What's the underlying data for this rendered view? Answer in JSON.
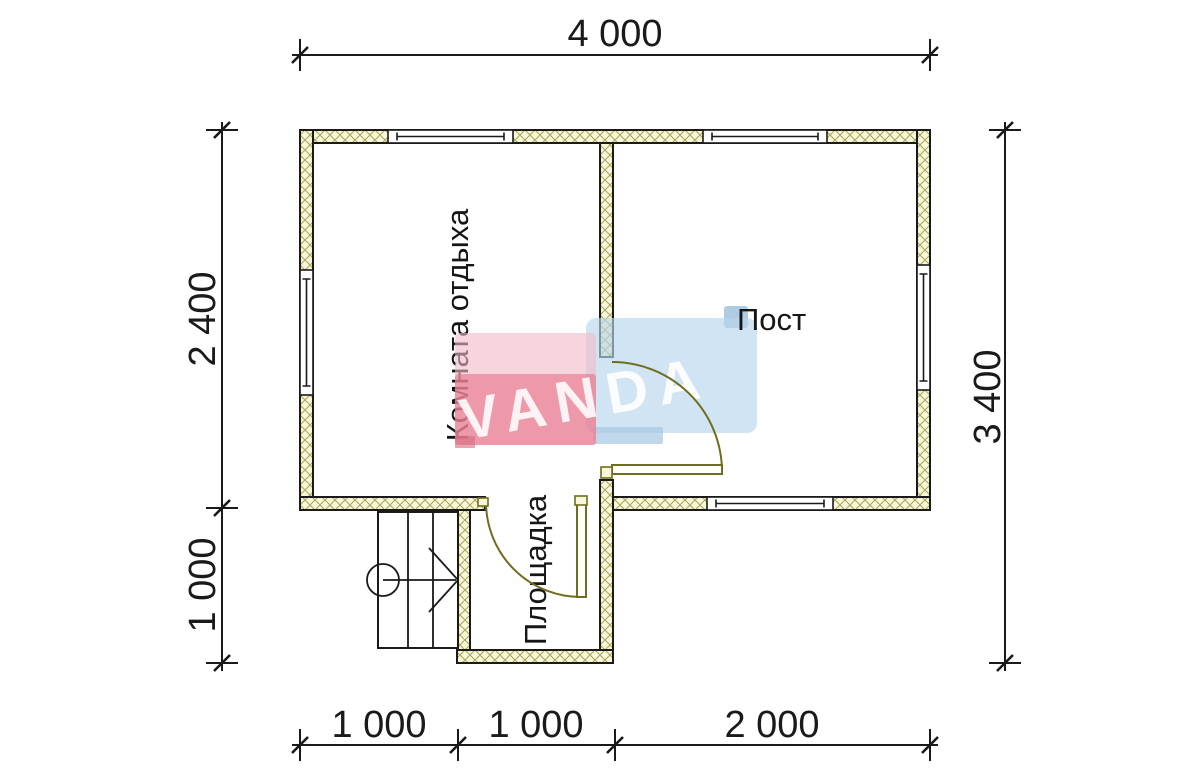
{
  "logo": {
    "text": "VANDA"
  },
  "rooms": [
    {
      "id": "rest-room",
      "label": "Комната отдыха"
    },
    {
      "id": "post-room",
      "label": "Пост"
    },
    {
      "id": "landing",
      "label": "Площадка"
    }
  ],
  "dimensions": {
    "top": "4 000",
    "left_upper": "2 400",
    "left_lower": "1 000",
    "right": "3 400",
    "bottom": [
      "1 000",
      "1 000",
      "2 000"
    ]
  },
  "colors": {
    "wall_fill": "#f8f7d8",
    "wall_hatch": "#a9a55c",
    "line": "#1a1a1a",
    "door": "#6e6e1e",
    "logo_pink": "#f2b9c8",
    "logo_red": "#e56780",
    "logo_red_dark": "#d96a7e",
    "logo_blue": "#b9d6ec",
    "logo_blue_dark": "#8fb6d7",
    "logo_step_blue": "#a5c8e2",
    "logo_letters": "#ffffff"
  }
}
